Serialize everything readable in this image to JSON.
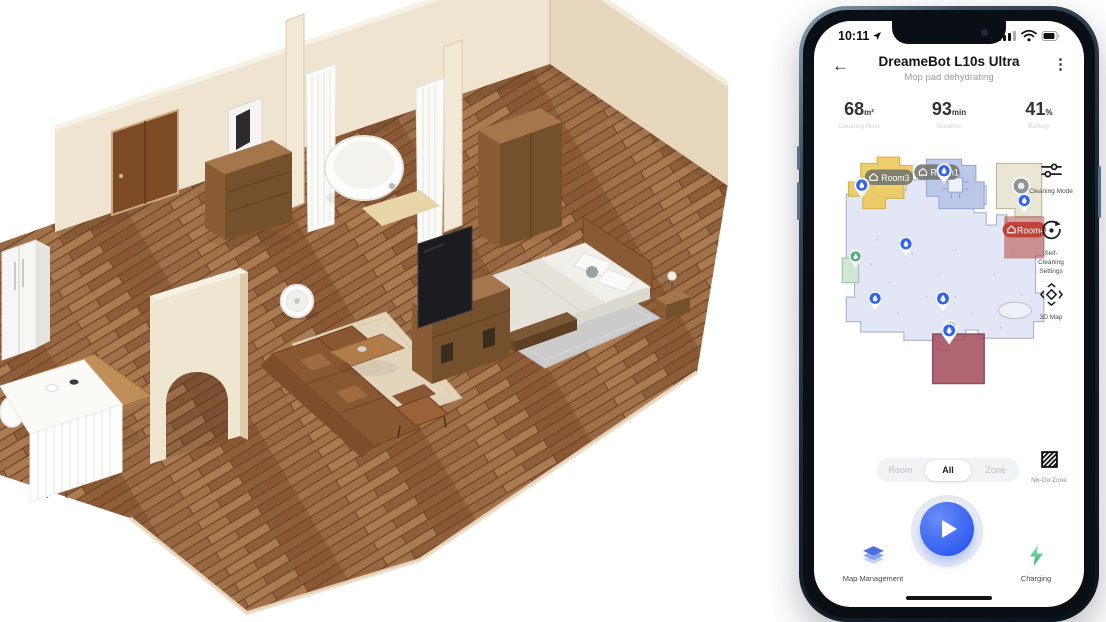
{
  "colors": {
    "accent_blue": "#2e5cf0",
    "charging_green": "#2fae69",
    "map_floor": "#e3e6f4",
    "map_room_yellow": "#ecca5e",
    "map_room_blue": "#b9c7ea",
    "map_room_beige": "#e9e6d5",
    "room4_red": "#bf4137",
    "no_go_zone_red": "#a8505f"
  },
  "status_bar": {
    "time": "10:11",
    "icons": [
      "location-arrow-icon",
      "cellular-icon",
      "wifi-icon",
      "battery-icon"
    ]
  },
  "header": {
    "title": "DreameBot L10s Ultra",
    "subtitle": "Mop pad dehydrating",
    "icons": [
      "back-arrow-icon",
      "more-kebab-icon"
    ]
  },
  "stats": [
    {
      "value": "68",
      "unit": "m²",
      "label": "Cleaning Area"
    },
    {
      "value": "93",
      "unit": "min",
      "label": "Runtime"
    },
    {
      "value": "41",
      "unit": "%",
      "label": "Battery"
    }
  ],
  "map": {
    "rooms": [
      {
        "label": "Room3"
      },
      {
        "label": "Room1"
      },
      {
        "label": "Room4"
      }
    ],
    "markers": [
      "water-pin",
      "water-pin",
      "water-pin",
      "water-pin",
      "water-pin",
      "water-pin",
      "water-pin",
      "green-pin",
      "robot-dot"
    ]
  },
  "side_actions": [
    {
      "icon": "sliders-icon",
      "label": "Cleaning Mode"
    },
    {
      "icon": "rotate-arrow-icon",
      "label": "Self-\nCleaning\nSettings"
    },
    {
      "icon": "move-3d-icon",
      "label": "3D Map"
    }
  ],
  "mode_tabs": {
    "options": [
      "Room",
      "All",
      "Zone"
    ],
    "selected": "All"
  },
  "no_go": {
    "icon": "hatched-square-icon",
    "label": "No-Go Zone"
  },
  "play": {
    "icon": "play-icon"
  },
  "bottom_bar": {
    "left_icon": "layers-icon",
    "left": "Map Management",
    "right_icon": "bolt-icon",
    "right": "Charging"
  }
}
